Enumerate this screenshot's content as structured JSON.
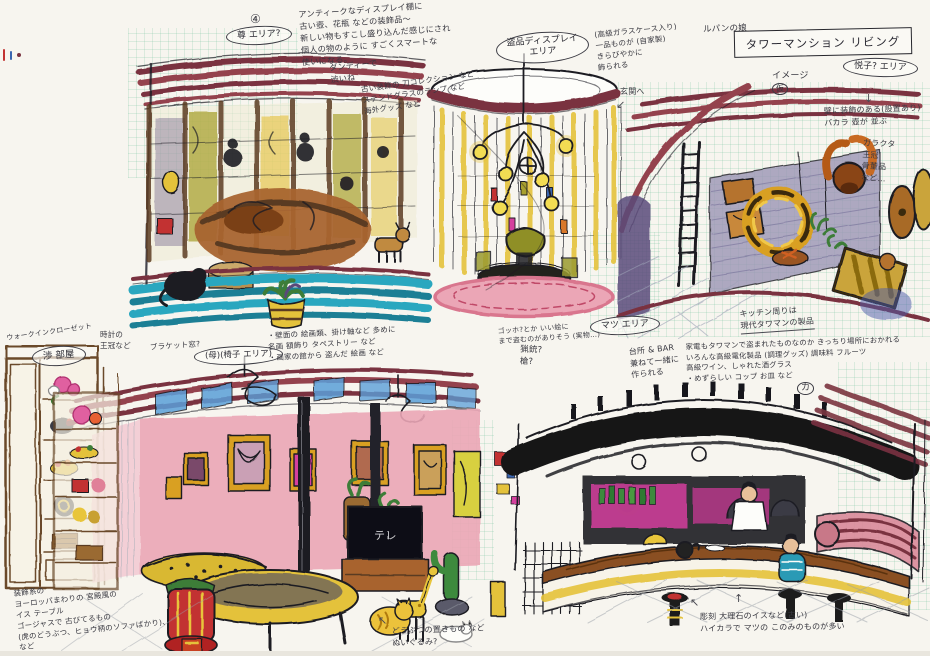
{
  "palette": {
    "paper": "#f7f5ef",
    "ink": "#1d1d24",
    "maroon": "#7a3340",
    "maroon2": "#94424e",
    "teal": "#2ba7bf",
    "teal2": "#1f7f95",
    "skyblue": "#5a9fd9",
    "blue": "#3a66b0",
    "yellow": "#e4c23a",
    "gold": "#d9a020",
    "olive": "#a8a02e",
    "pink": "#eba6b6",
    "pinkdeep": "#d9768e",
    "magenta": "#d53f9e",
    "red": "#c23333",
    "green": "#3e7d38",
    "brown": "#8a5526",
    "brown2": "#a8642f",
    "darkwood": "#5a3a20",
    "purple": "#5a4a7a",
    "wallpurple": "#9a95b5",
    "gray": "#8a8a8a",
    "skin": "#e8c09a",
    "white": "#fdfdfa"
  },
  "header": {
    "project": "ルパンの娘",
    "title": "タワーマンション リビング",
    "image_label": "イメージ",
    "image_label_mark": "仮"
  },
  "markers": {
    "circle_4": "④",
    "circle_ka": "カ"
  },
  "areas": {
    "takeru": "尊 エリア?",
    "stolen_display": "盗品ディスプレイ\nエリア",
    "etsuko": "悦子? エリア",
    "wataru_room": "渉 部屋",
    "mother_chair": "(母)(椅子 エリア)",
    "matsu": "マツ エリア"
  },
  "notes": {
    "display_shelf": "アンティークなディスプレイ棚に\n古い壺、花瓶 などの装飾品〜\n新しい物もすこし盛り込んだ感じにされ\n個人の物のように すごくスマートな\n使いになる。",
    "dandy": "ダンディーで\n渋いね",
    "sword_collection": "古い装飾の 刀コレクション など\nステンドグラスのランプ など\n海外グッズ など",
    "glass_case": "(高級ガラスケース入り)\n一品ものが (自家製)\nきらびやかに\n飾られる",
    "entrance": "玄関へ",
    "wall_decor": "壁に装飾のある(設置あり)\nバカラ 壺が 並ぶ",
    "wall_decor2": "ガラクタ\n王冠\n骨董品\nなど…",
    "closet": "ウォークインクローゼット",
    "crown": "時計の\n王冠など",
    "bracket_window": "ブラケット窓?",
    "paintings": "・壁面の 絵画類、掛け軸など 多めに\n名画 額飾り タペストリー など\n・画家の館から 盗んだ 絵画 など",
    "gogh": "ゴッホ?とか いい絵に\nまで盗むのがありそう (実物…)",
    "rifle": "猟銃?\n槍?",
    "bar_kitchen": "台所 & BAR\n兼ねて一緒に\n作られる",
    "kitchen_modern": "キッチン周りは\n現代タワマンの製品",
    "kitchen_detail": "家電もタワマンで盗まれたものなのか きっちり場所におかれる\nいろんな高級電化製品 (調理グッズ) 調味料 フルーツ\n高級ワイン、しゃれた酒グラス\n・めずらしい コップ お皿 など",
    "palace_furniture": "装飾系の\nヨーロッパまわりの 宮殿風の\nイス テーブル\nゴージャスで 古びてるもの\n(虎のどうぶつ、ヒョウ柄のソファばかり)、\nなど",
    "animal_figures": "どうぶつの置きもの など\nぬいぐるみ?",
    "antique_chairs": "彫刻 大理石のイスなど(古い)\nハイカラで マツの このみのものが多い"
  },
  "sketch_labels": {
    "tv": "テレ"
  }
}
